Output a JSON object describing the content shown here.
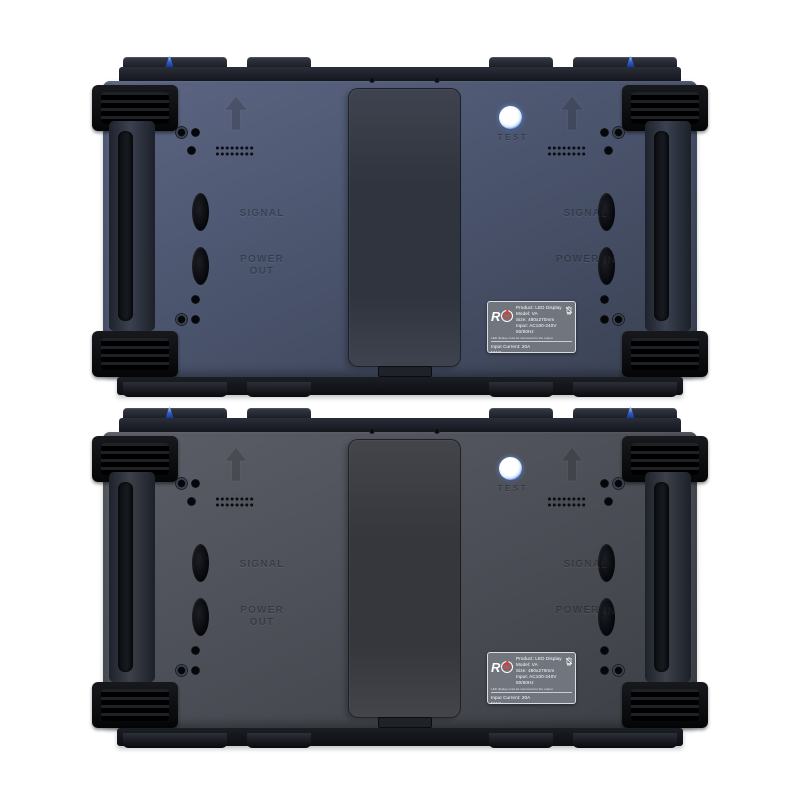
{
  "scene": {
    "type": "product-photo",
    "description": "Rear view of two stacked LED display cabinets",
    "background": "#ffffff"
  },
  "labels": {
    "signal": "SIGNAL",
    "power_out": "POWER OUT",
    "power_in": "POWER IN",
    "test": "TEST"
  },
  "sticker": {
    "logo_text": "R",
    "product": "Product: LED Display",
    "model": "Model: VA",
    "size": "Size: 480x270mm",
    "input": "Input: AC100-240V 50/60Hz",
    "note": "LED display must be connected to the output",
    "input_current": "Input Current: 20A MAX",
    "output": "Output: AC100-240V 50/60Hz",
    "output_current": "Output Current: 17.5A MAX",
    "certs": {
      "fcc": "FC",
      "ce": "CE"
    }
  },
  "accents": {
    "test_button_blue": "#4a7ae0",
    "lock_pin_blue": "#2f63d6",
    "logo_red": "#e2372b",
    "label_bg": "#70757e"
  },
  "panels": [
    {
      "name": "top-cabinet",
      "colors": {
        "body-a": "#5c6683",
        "body-b": "#4b556e",
        "body-c": "#3a4153",
        "rect-a": "#3f434f",
        "rect-b": "#30343e",
        "rail": "#3a4150"
      }
    },
    {
      "name": "bottom-cabinet",
      "colors": {
        "body-a": "#5b5e66",
        "body-b": "#4d5058",
        "body-c": "#3c3f45",
        "rect-a": "#43454b",
        "rect-b": "#35373c",
        "rail": "#3d4048"
      }
    }
  ]
}
